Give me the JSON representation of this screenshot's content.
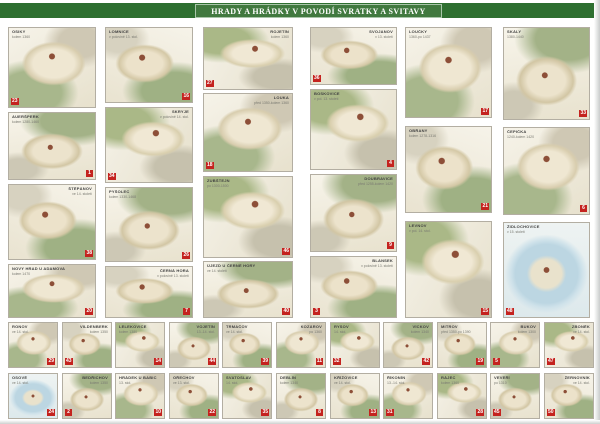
{
  "poster": {
    "title": "HRADY A HRÁDKY V POVODÍ SVRATKY A SVITAVY",
    "colors": {
      "banner_green": "#2e6f30",
      "title_box_green": "#41793f",
      "badge_red": "#c4231f",
      "panel_border": "#b3aea2",
      "page": "#ffffff"
    },
    "panels_main": [
      {
        "name": "OSIKY",
        "date": "kolem 1360",
        "num": "23",
        "x": 8,
        "y": 27,
        "w": 88,
        "h": 81,
        "label": "tl",
        "badge": "bl",
        "art": 1
      },
      {
        "name": "LOMNICE",
        "date": "v polovině 13. stol.",
        "num": "16",
        "x": 105,
        "y": 27,
        "w": 88,
        "h": 76,
        "label": "tl",
        "badge": "br",
        "art": 2
      },
      {
        "name": "ROJETÍN",
        "date": "kolem 1360",
        "num": "27",
        "x": 203,
        "y": 27,
        "w": 90,
        "h": 63,
        "label": "tr",
        "badge": "bl",
        "art": 3
      },
      {
        "name": "AUERŠPERK",
        "date": "kolem 1280-1460",
        "num": "1",
        "x": 8,
        "y": 112,
        "w": 88,
        "h": 68,
        "label": "tl",
        "badge": "br",
        "art": 4
      },
      {
        "name": "SKRYJE",
        "date": "v polovině 14. stol.",
        "num": "34",
        "x": 105,
        "y": 107,
        "w": 88,
        "h": 76,
        "label": "tr",
        "badge": "bl",
        "art": 3
      },
      {
        "name": "LOUKA",
        "date": "před 1350-kolem 1360",
        "num": "18",
        "x": 203,
        "y": 93,
        "w": 90,
        "h": 79,
        "label": "tr",
        "badge": "bl",
        "art": 1
      },
      {
        "name": "ŠTĚPÁNOV",
        "date": "ve 14. století",
        "num": "38",
        "x": 8,
        "y": 184,
        "w": 88,
        "h": 76,
        "label": "tr",
        "badge": "br",
        "art": 2
      },
      {
        "name": "PYŠOLEC",
        "date": "kolem 1330-1468",
        "num": "26",
        "x": 105,
        "y": 187,
        "w": 88,
        "h": 75,
        "label": "tl",
        "badge": "br",
        "art": 4
      },
      {
        "name": "ZUBŠTEJN",
        "date": "po 1300-1500",
        "num": "46",
        "x": 203,
        "y": 176,
        "w": 90,
        "h": 82,
        "label": "tl",
        "badge": "br",
        "art": 3
      },
      {
        "name": "NOVÝ HRAD U ADAMOVA",
        "date": "kolem 1470",
        "num": "20",
        "x": 8,
        "y": 264,
        "w": 88,
        "h": 54,
        "label": "tl",
        "badge": "br",
        "art": 1
      },
      {
        "name": "ČERNÁ HORA",
        "date": "v polovině 13. století",
        "num": "7",
        "x": 105,
        "y": 266,
        "w": 88,
        "h": 52,
        "label": "tr",
        "badge": "br",
        "art": 2
      },
      {
        "name": "ÚJEZD U ČERNÉ HORY",
        "date": "ve 14. století",
        "num": "40",
        "x": 203,
        "y": 261,
        "w": 90,
        "h": 57,
        "label": "tl",
        "badge": "br",
        "art": 4
      },
      {
        "name": "SVOJANOV",
        "date": "v 13. století",
        "num": "36",
        "x": 310,
        "y": 27,
        "w": 87,
        "h": 58,
        "label": "tr",
        "badge": "bl",
        "art": 2
      },
      {
        "name": "LOUČKY",
        "date": "1360-po 1437",
        "num": "17",
        "x": 405,
        "y": 27,
        "w": 87,
        "h": 91,
        "label": "tl",
        "badge": "br",
        "art": 1
      },
      {
        "name": "SKÁLY",
        "date": "1380-1440",
        "num": "33",
        "x": 503,
        "y": 27,
        "w": 87,
        "h": 93,
        "label": "tl",
        "badge": "br",
        "art": 4
      },
      {
        "name": "BOSKOVICE",
        "date": "v pol. 13. století",
        "num": "4",
        "x": 310,
        "y": 89,
        "w": 87,
        "h": 81,
        "label": "tl",
        "badge": "br",
        "art": 3
      },
      {
        "name": "OBŘANY",
        "date": "kolem 1278-1316",
        "num": "21",
        "x": 405,
        "y": 126,
        "w": 87,
        "h": 87,
        "label": "tl",
        "badge": "br",
        "art": 2
      },
      {
        "name": "ČEPIČKA",
        "date": "1240-kolem 1420",
        "num": "6",
        "x": 503,
        "y": 127,
        "w": 87,
        "h": 88,
        "label": "tl",
        "badge": "br",
        "art": 1
      },
      {
        "name": "DOUBRAVICE",
        "date": "před 1255-kolem 1420",
        "num": "9",
        "x": 310,
        "y": 174,
        "w": 87,
        "h": 78,
        "label": "tr",
        "badge": "br",
        "art": 4
      },
      {
        "name": "LEVNOV",
        "date": "v pol. 14. stol.",
        "num": "15",
        "x": 405,
        "y": 221,
        "w": 87,
        "h": 97,
        "label": "tl",
        "badge": "br",
        "art": 3
      },
      {
        "name": "ŽIDLOCHOVICE",
        "date": "v 15. století",
        "num": "48",
        "x": 503,
        "y": 222,
        "w": 87,
        "h": 96,
        "label": "tl",
        "badge": "bl",
        "art": 5
      },
      {
        "name": "BLANSEK",
        "date": "v polovině 13. století",
        "num": "3",
        "x": 310,
        "y": 256,
        "w": 87,
        "h": 62,
        "label": "tr",
        "badge": "bl",
        "art": 2
      }
    ],
    "panels_small_row1": [
      {
        "name": "RONOV",
        "date": "ve 14. stol.",
        "num": "29",
        "x": 8,
        "y": 322,
        "w": 50,
        "h": 46,
        "label": "tl",
        "badge": "br",
        "art": 1
      },
      {
        "name": "VILDENBERK",
        "date": "kolem 1350",
        "num": "43",
        "x": 62,
        "y": 322,
        "w": 50,
        "h": 46,
        "label": "tr",
        "badge": "bl",
        "art": 2
      },
      {
        "name": "LELEKOVICE",
        "date": "kolem 1380",
        "num": "14",
        "x": 115,
        "y": 322,
        "w": 50,
        "h": 46,
        "label": "tl",
        "badge": "br",
        "art": 3
      },
      {
        "name": "VOJETÍN",
        "date": "13.-14. stol.",
        "num": "44",
        "x": 169,
        "y": 322,
        "w": 50,
        "h": 46,
        "label": "tr",
        "badge": "br",
        "art": 4
      },
      {
        "name": "TRMAČOV",
        "date": "ve 14. stol.",
        "num": "39",
        "x": 222,
        "y": 322,
        "w": 50,
        "h": 46,
        "label": "tl",
        "badge": "br",
        "art": 2
      },
      {
        "name": "KOZÁROV",
        "date": "po 1360",
        "num": "11",
        "x": 276,
        "y": 322,
        "w": 50,
        "h": 46,
        "label": "tr",
        "badge": "br",
        "art": 1
      },
      {
        "name": "RYSOV",
        "date": "14. stol.",
        "num": "32",
        "x": 330,
        "y": 322,
        "w": 50,
        "h": 46,
        "label": "tl",
        "badge": "bl",
        "art": 3
      },
      {
        "name": "VÍCKOV",
        "date": "kolem 1340",
        "num": "42",
        "x": 383,
        "y": 322,
        "w": 50,
        "h": 46,
        "label": "tr",
        "badge": "br",
        "art": 4
      },
      {
        "name": "MITROV",
        "date": "před 1350-po 1390",
        "num": "19",
        "x": 437,
        "y": 322,
        "w": 50,
        "h": 46,
        "label": "tl",
        "badge": "br",
        "art": 2
      },
      {
        "name": "BUKOV",
        "date": "kolem 1300",
        "num": "5",
        "x": 490,
        "y": 322,
        "w": 50,
        "h": 46,
        "label": "tr",
        "badge": "bl",
        "art": 1
      },
      {
        "name": "ZBONĚK",
        "date": "ve 14. stol.",
        "num": "47",
        "x": 544,
        "y": 322,
        "w": 50,
        "h": 46,
        "label": "tr",
        "badge": "bl",
        "art": 3
      }
    ],
    "panels_small_row2": [
      {
        "name": "OSOVÉ",
        "date": "ve 14. stol.",
        "num": "24",
        "x": 8,
        "y": 373,
        "w": 50,
        "h": 46,
        "label": "tl",
        "badge": "br",
        "art": 5
      },
      {
        "name": "BEDŘICHOV",
        "date": "kolem 1350",
        "num": "2",
        "x": 62,
        "y": 373,
        "w": 50,
        "h": 46,
        "label": "tr",
        "badge": "bl",
        "art": 4
      },
      {
        "name": "HRÁDEK U BABIC",
        "date": "13. stol.",
        "num": "10",
        "x": 115,
        "y": 373,
        "w": 50,
        "h": 46,
        "label": "tl",
        "badge": "br",
        "art": 1
      },
      {
        "name": "OŘECHOV",
        "date": "ve 13. stol.",
        "num": "22",
        "x": 169,
        "y": 373,
        "w": 50,
        "h": 46,
        "label": "tl",
        "badge": "br",
        "art": 2
      },
      {
        "name": "SVATOSLAV",
        "date": "14. stol.",
        "num": "35",
        "x": 222,
        "y": 373,
        "w": 50,
        "h": 46,
        "label": "tl",
        "badge": "br",
        "art": 3
      },
      {
        "name": "DEBLÍN",
        "date": "kolem 1340",
        "num": "8",
        "x": 276,
        "y": 373,
        "w": 50,
        "h": 46,
        "label": "tl",
        "badge": "br",
        "art": 4
      },
      {
        "name": "KŘÍŽOVICE",
        "date": "ve 14. stol.",
        "num": "13",
        "x": 330,
        "y": 373,
        "w": 50,
        "h": 46,
        "label": "tl",
        "badge": "br",
        "art": 2
      },
      {
        "name": "ŘÍKONÍN",
        "date": "13.-14. stol.",
        "num": "31",
        "x": 383,
        "y": 373,
        "w": 50,
        "h": 46,
        "label": "tl",
        "badge": "bl",
        "art": 1
      },
      {
        "name": "RÁJEC",
        "date": "kolem 1360",
        "num": "28",
        "x": 437,
        "y": 373,
        "w": 50,
        "h": 46,
        "label": "tl",
        "badge": "br",
        "art": 3
      },
      {
        "name": "VEVEŘÍ",
        "date": "po 1310",
        "num": "45",
        "x": 490,
        "y": 373,
        "w": 50,
        "h": 46,
        "label": "tl",
        "badge": "bl",
        "art": 4
      },
      {
        "name": "ŽERNOVNÍK",
        "date": "ve 14. stol.",
        "num": "50",
        "x": 544,
        "y": 373,
        "w": 50,
        "h": 46,
        "label": "tr",
        "badge": "bl",
        "art": 2
      }
    ]
  }
}
